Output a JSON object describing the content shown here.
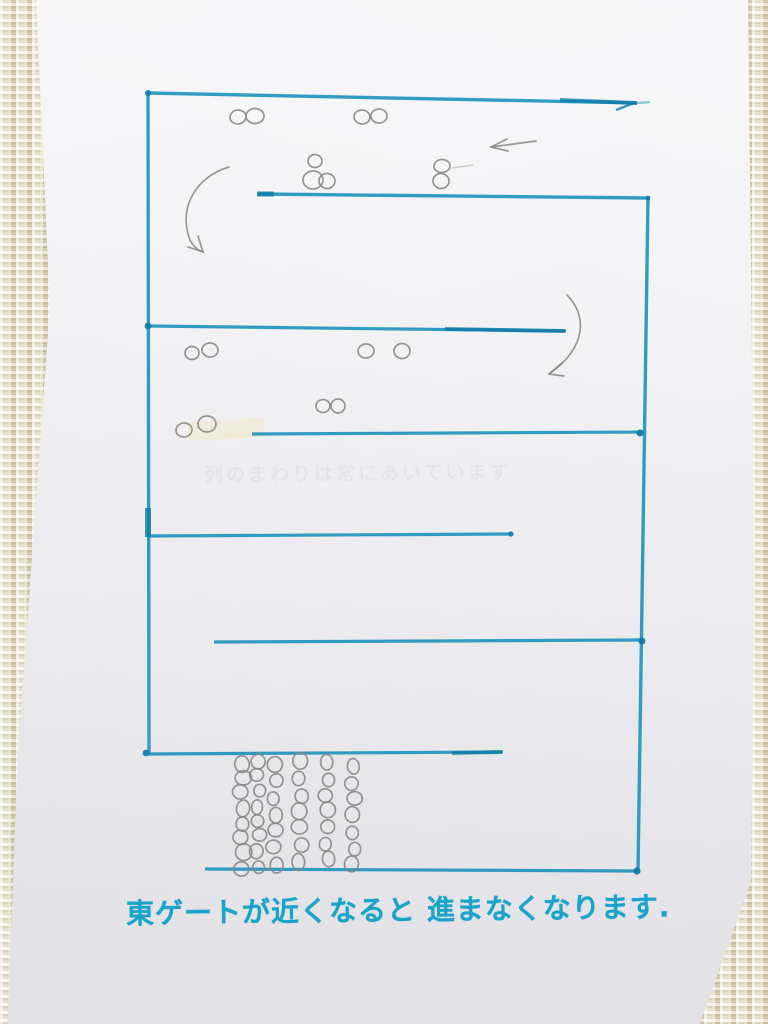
{
  "scene": {
    "description": "hand-drawn serpentine queue diagram in teal marker on a white sheet lying on woven fabric",
    "caption": "東ゲートが近くなると 進まなくなります.",
    "erased_note": "列のまわりは常にあいています"
  },
  "colors": {
    "fabric_light": "#f2edd8",
    "fabric_dark": "#ddd4b6",
    "paper": "#f4f3f6",
    "marker": "#2095bd",
    "marker_dark": "#0d7aa6",
    "pencil": "#8a8885",
    "tape": "#f1ecd9",
    "caption_ink": "#1ba4c9"
  },
  "drawing": {
    "marker_lines": [
      {
        "name": "top-wall",
        "x1": 148,
        "y1": 93,
        "x2": 637,
        "y2": 103,
        "w": 3.4
      },
      {
        "name": "top-wall-tip",
        "x1": 637,
        "y1": 103,
        "x2": 650,
        "y2": 102,
        "w": 2.2,
        "light": true
      },
      {
        "name": "left-wall",
        "x1": 148,
        "y1": 93,
        "x2": 149,
        "y2": 754,
        "w": 3.4
      },
      {
        "name": "lane2-wall",
        "x1": 258,
        "y1": 194,
        "x2": 648,
        "y2": 198,
        "w": 3.4
      },
      {
        "name": "right-wall",
        "x1": 648,
        "y1": 198,
        "x2": 638,
        "y2": 871,
        "w": 3.4
      },
      {
        "name": "lane3-wall",
        "x1": 148,
        "y1": 326,
        "x2": 566,
        "y2": 331,
        "w": 3.2
      },
      {
        "name": "lane4-wall",
        "x1": 252,
        "y1": 434,
        "x2": 644,
        "y2": 432,
        "w": 3.2
      },
      {
        "name": "lane5-wall",
        "x1": 148,
        "y1": 536,
        "x2": 511,
        "y2": 534,
        "w": 3.2
      },
      {
        "name": "lane6-wall",
        "x1": 214,
        "y1": 642,
        "x2": 642,
        "y2": 640,
        "w": 3.2
      },
      {
        "name": "lane7-wall",
        "x1": 148,
        "y1": 754,
        "x2": 503,
        "y2": 752,
        "w": 3.2
      },
      {
        "name": "bottom-wall",
        "x1": 205,
        "y1": 869,
        "x2": 637,
        "y2": 871,
        "w": 3.2
      }
    ],
    "marker_overdraws": [
      {
        "x1": 560,
        "y1": 100,
        "x2": 637,
        "y2": 103,
        "w": 3.8
      },
      {
        "x1": 634,
        "y1": 103,
        "x2": 616,
        "y2": 110,
        "w": 2.4
      },
      {
        "x1": 445,
        "y1": 329,
        "x2": 565,
        "y2": 331,
        "w": 3.8
      },
      {
        "x1": 452,
        "y1": 753,
        "x2": 502,
        "y2": 752,
        "w": 3.8
      },
      {
        "x1": 257,
        "y1": 194,
        "x2": 274,
        "y2": 194,
        "w": 5
      },
      {
        "x1": 148,
        "y1": 508,
        "x2": 148,
        "y2": 537,
        "w": 6
      }
    ],
    "marker_dots": [
      {
        "x": 148,
        "y": 93,
        "r": 3
      },
      {
        "x": 148,
        "y": 326,
        "r": 3.4
      },
      {
        "x": 640,
        "y": 433,
        "r": 3.5
      },
      {
        "x": 511,
        "y": 534,
        "r": 2.6
      },
      {
        "x": 642,
        "y": 641,
        "r": 3.5
      },
      {
        "x": 146,
        "y": 753,
        "r": 3.4
      },
      {
        "x": 637,
        "y": 871,
        "r": 3.6
      },
      {
        "x": 648,
        "y": 198,
        "r": 2.4
      }
    ],
    "tape": {
      "x": 188,
      "y": 420,
      "w": 76,
      "h": 19,
      "rot": -3
    },
    "pencil_circles": [
      [
        238,
        117,
        8,
        7
      ],
      [
        255,
        116,
        9,
        7.5
      ],
      [
        362,
        117,
        8,
        7
      ],
      [
        379,
        116,
        8,
        7
      ],
      [
        315,
        161,
        7,
        6.5
      ],
      [
        313,
        180,
        10,
        9
      ],
      [
        327,
        181,
        8,
        7.5
      ],
      [
        442,
        166,
        8,
        6.5
      ],
      [
        441,
        181,
        8,
        7.5
      ],
      [
        192,
        353,
        7,
        6.5
      ],
      [
        210,
        350,
        8,
        7
      ],
      [
        366,
        351,
        8,
        7
      ],
      [
        402,
        351,
        8,
        7.5
      ],
      [
        323,
        406,
        7,
        6.5
      ],
      [
        338,
        406,
        7,
        7
      ],
      [
        184,
        430,
        8,
        7
      ],
      [
        207,
        424,
        9,
        8
      ]
    ],
    "pencil_dash": {
      "x1": 452,
      "y1": 168,
      "x2": 473,
      "y2": 165
    },
    "queue_grid": {
      "columns": [
        {
          "x": 242,
          "y0": 763,
          "dy": 15,
          "count": 8,
          "r": 8
        },
        {
          "x": 258,
          "y0": 761,
          "dy": 15,
          "count": 8,
          "r": 7
        },
        {
          "x": 275,
          "y0": 765,
          "dy": 16.5,
          "count": 7,
          "r": 7.5
        },
        {
          "x": 300,
          "y0": 762,
          "dy": 16.5,
          "count": 7,
          "r": 8
        },
        {
          "x": 327,
          "y0": 763,
          "dy": 16,
          "count": 7,
          "r": 7.5
        },
        {
          "x": 353,
          "y0": 766,
          "dy": 16.5,
          "count": 7,
          "r": 7.5
        }
      ]
    },
    "arrows": [
      {
        "name": "arrow-left",
        "path": "M 536 141 L 491 147",
        "barbs": [
          [
            491,
            147,
            507,
            139
          ],
          [
            491,
            147,
            508,
            151
          ]
        ]
      },
      {
        "name": "curved-arrow-down-left",
        "path": "M 229 167 C 198 176 177 206 190 240 C 193 246 197 250 203 252",
        "barbs": [
          [
            203,
            252,
            188,
            247
          ],
          [
            203,
            252,
            198,
            236
          ]
        ]
      },
      {
        "name": "curved-arrow-down-right",
        "path": "M 567 295 C 585 313 590 345 549 374",
        "barbs": [
          [
            549,
            374,
            562,
            363
          ],
          [
            549,
            374,
            564,
            376
          ]
        ]
      }
    ]
  }
}
